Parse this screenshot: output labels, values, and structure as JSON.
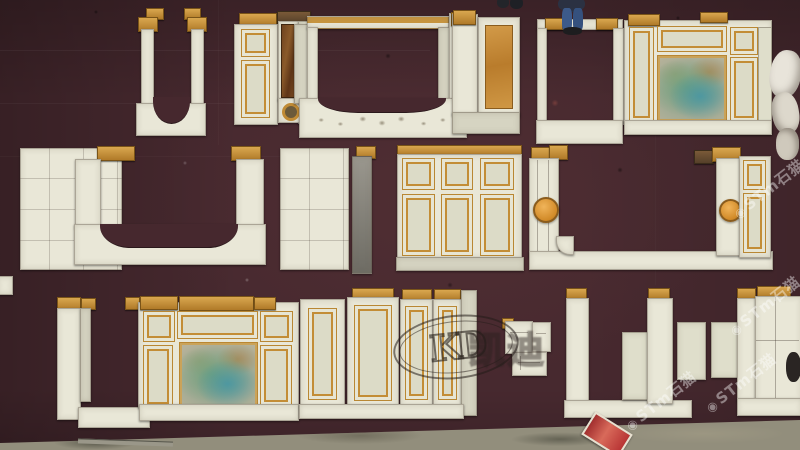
{
  "scene": {
    "subject": "overhead photo of carved white marble wall paneling and fireplace components laid out on a maroon carpet"
  },
  "watermarks": {
    "kd_logo": {
      "text": "KD"
    },
    "kd_chinese": {
      "text": "凯迪"
    },
    "stm": {
      "logo": "◉",
      "text": "STm石猫"
    }
  },
  "palette": {
    "carpet": "#47292f",
    "concrete": "#928e7c",
    "marble_cream": "#e9e7d7",
    "gold_trim": "#c38d36",
    "tan_cap": "#c8973f",
    "orange_marble": "#cd8f3d",
    "brown_marble": "#6f431f",
    "green_onyx": "#7f9f8b",
    "medallion_orange": "#d18a28",
    "jeans_blue": "#3d5a8a",
    "red_tag": "#b83434"
  }
}
